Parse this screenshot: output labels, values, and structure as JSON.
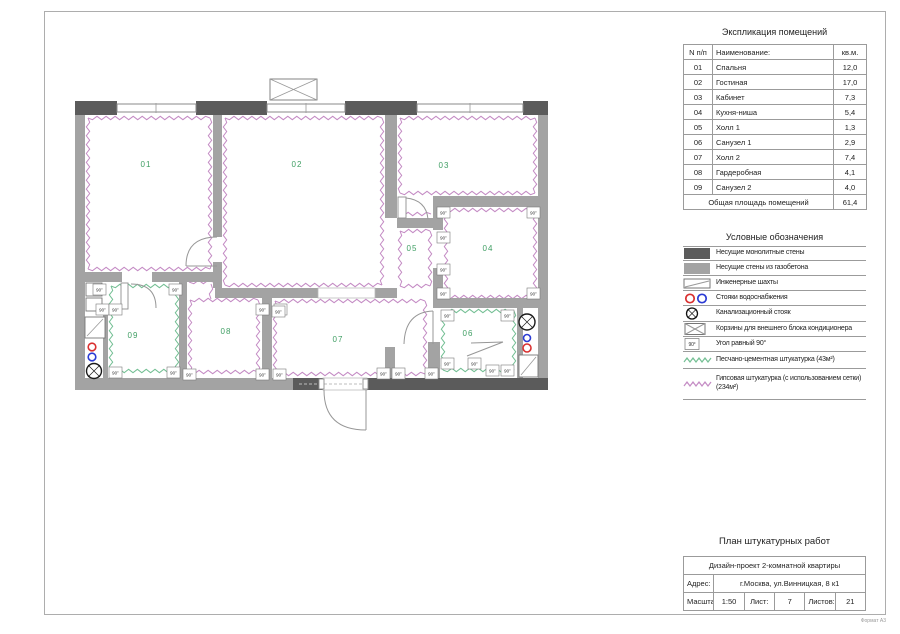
{
  "sheet": {
    "format_label": "Формат А3"
  },
  "plan": {
    "angle_label": "90°",
    "rooms": [
      "01",
      "02",
      "03",
      "04",
      "05",
      "06",
      "07",
      "08",
      "09"
    ]
  },
  "explication": {
    "title": "Экспликация помещений",
    "columns": [
      "N п/п",
      "Наименование:",
      "кв.м."
    ],
    "rows": [
      {
        "num": "01",
        "name": "Спальня",
        "area": "12,0"
      },
      {
        "num": "02",
        "name": "Гостиная",
        "area": "17,0"
      },
      {
        "num": "03",
        "name": "Кабинет",
        "area": "7,3"
      },
      {
        "num": "04",
        "name": "Кухня-ниша",
        "area": "5,4"
      },
      {
        "num": "05",
        "name": "Холл 1",
        "area": "1,3"
      },
      {
        "num": "06",
        "name": "Санузел 1",
        "area": "2,9"
      },
      {
        "num": "07",
        "name": "Холл 2",
        "area": "7,4"
      },
      {
        "num": "08",
        "name": "Гардеробная",
        "area": "4,1"
      },
      {
        "num": "09",
        "name": "Санузел 2",
        "area": "4,0"
      }
    ],
    "total_label": "Общая площадь помещений",
    "total_area": "61,4"
  },
  "legend": {
    "title": "Условные обозначения",
    "items": [
      {
        "symbol": "wall-monolithic",
        "label": "Несущие монолитные стены"
      },
      {
        "symbol": "wall-gas-concrete",
        "label": "Несущие стены из газобетона"
      },
      {
        "symbol": "engineering-shaft",
        "label": "Инженерные шахты"
      },
      {
        "symbol": "water-risers",
        "label": "Стояки водоснабжения"
      },
      {
        "symbol": "sewer-riser",
        "label": "Канализационный стояк"
      },
      {
        "symbol": "ac-basket",
        "label": "Корзины для внешнего блока кондиционера"
      },
      {
        "symbol": "right-angle",
        "label": "Угол равный 90°"
      },
      {
        "symbol": "cement-plaster",
        "label": "Песчано-цементная штукатурка (43м²)"
      },
      {
        "symbol": "gypsum-plaster",
        "label": "Гипсовая штукатурка (с использованием сетки) (234м²)"
      }
    ]
  },
  "titleblock": {
    "drawing_title": "План штукатурных работ",
    "project": "Дизайн-проект 2-комнатной квартиры",
    "address_label": "Адрес:",
    "address": "г.Москва, ул.Винницкая, 8 к1",
    "scale_label": "Масштаб:",
    "scale": "1:50",
    "sheet_label": "Лист:",
    "sheet_number": "7",
    "sheets_label": "Листов:",
    "sheets_total": "21"
  },
  "colors": {
    "wall_dark": "#5b5b5b",
    "wall_medium": "#a3a3a3",
    "plaster_pink": "#c48bc4",
    "plaster_green": "#74bf94",
    "riser_red": "#d93030",
    "riser_blue": "#2b3bd4",
    "label_green": "#3f9e63",
    "line_gray": "#9b9b9b"
  }
}
